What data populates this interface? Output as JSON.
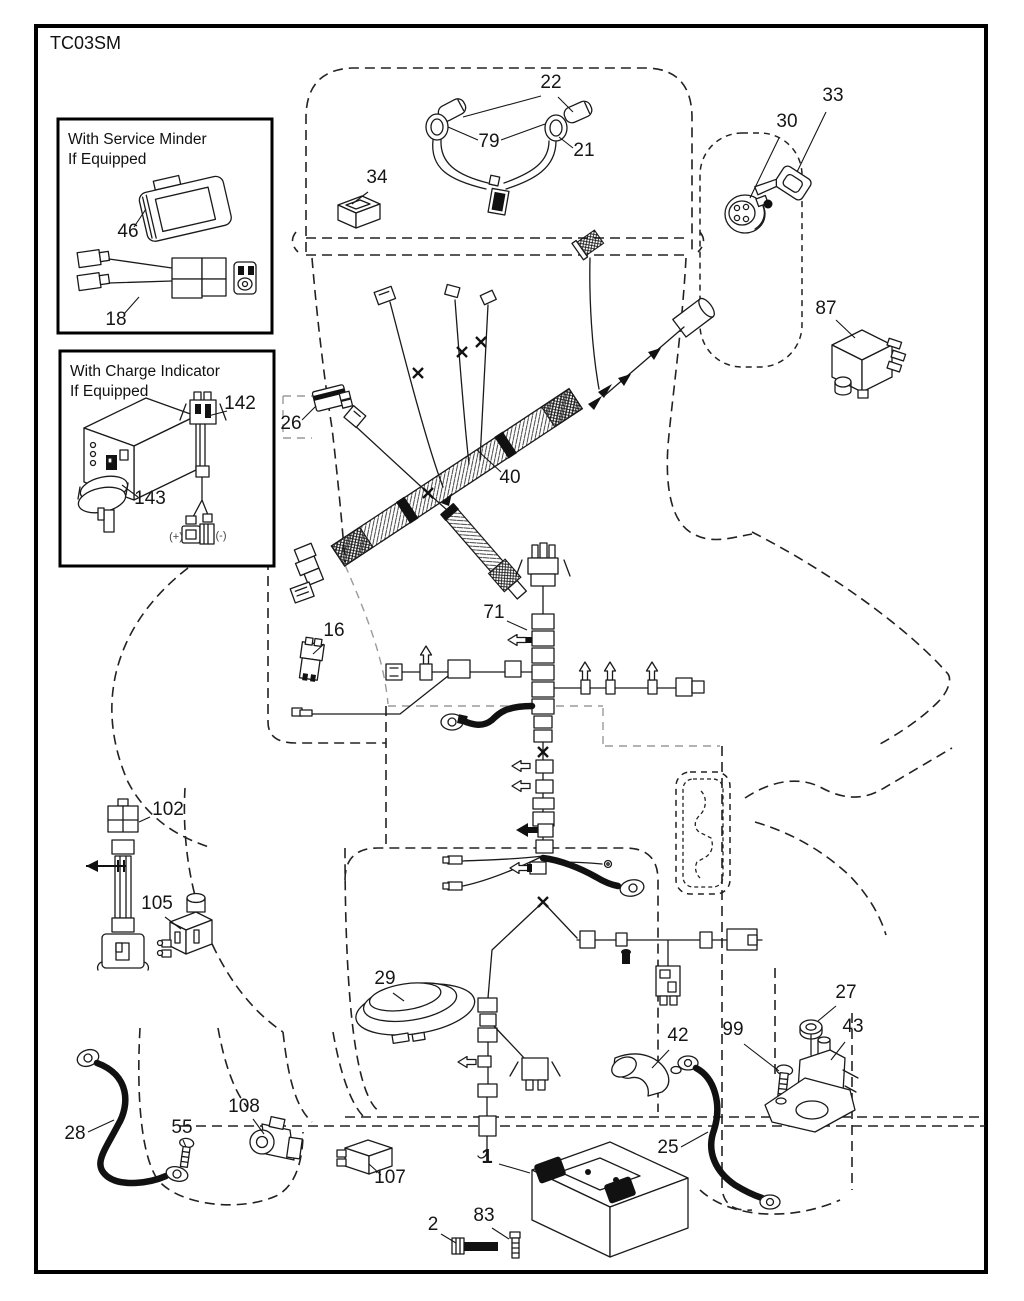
{
  "page": {
    "code": "TC03SM",
    "ink_color": "#1a1a1a",
    "background": "#ffffff"
  },
  "insets": {
    "service_minder": {
      "line1": "With Service Minder",
      "line2": "If Equipped"
    },
    "charge_indicator": {
      "line1": "With Charge Indicator",
      "line2": "If Equipped"
    }
  },
  "callouts": [
    {
      "id": "22",
      "label": "22",
      "x": 551,
      "y": 88,
      "leaders": [
        [
          541,
          96,
          463,
          117
        ],
        [
          558,
          97,
          573,
          112
        ]
      ]
    },
    {
      "id": "79",
      "label": "79",
      "x": 489,
      "y": 147,
      "leaders": [
        [
          478,
          140,
          448,
          127
        ],
        [
          501,
          140,
          545,
          124
        ]
      ]
    },
    {
      "id": "21",
      "label": "21",
      "x": 584,
      "y": 156,
      "leaders": [
        [
          573,
          148,
          559,
          137
        ]
      ]
    },
    {
      "id": "34",
      "label": "34",
      "x": 377,
      "y": 183,
      "leaders": [
        [
          368,
          192,
          352,
          204
        ]
      ]
    },
    {
      "id": "30",
      "label": "30",
      "x": 787,
      "y": 127,
      "leaders": [
        [
          779,
          138,
          750,
          198
        ]
      ]
    },
    {
      "id": "33",
      "label": "33",
      "x": 833,
      "y": 101,
      "leaders": [
        [
          826,
          112,
          797,
          172
        ]
      ]
    },
    {
      "id": "87",
      "label": "87",
      "x": 826,
      "y": 314,
      "leaders": [
        [
          836,
          320,
          855,
          338
        ]
      ]
    },
    {
      "id": "26",
      "label": "26",
      "x": 291,
      "y": 429,
      "leaders": [
        [
          302,
          420,
          316,
          406
        ]
      ]
    },
    {
      "id": "40",
      "label": "40",
      "x": 510,
      "y": 483,
      "leaders": [
        [
          501,
          472,
          477,
          450
        ]
      ]
    },
    {
      "id": "71",
      "label": "71",
      "x": 494,
      "y": 618,
      "leaders": [
        [
          507,
          621,
          527,
          630
        ]
      ]
    },
    {
      "id": "16",
      "label": "16",
      "x": 334,
      "y": 636,
      "leaders": [
        [
          324,
          644,
          313,
          654
        ]
      ]
    },
    {
      "id": "102",
      "label": "102",
      "x": 168,
      "y": 815,
      "leaders": [
        [
          150,
          817,
          139,
          822
        ]
      ]
    },
    {
      "id": "105",
      "label": "105",
      "x": 157,
      "y": 909,
      "leaders": [
        [
          165,
          917,
          181,
          929
        ]
      ]
    },
    {
      "id": "29",
      "label": "29",
      "x": 385,
      "y": 984,
      "leaders": [
        [
          393,
          993,
          404,
          1001
        ]
      ]
    },
    {
      "id": "42",
      "label": "42",
      "x": 678,
      "y": 1041,
      "leaders": [
        [
          669,
          1050,
          652,
          1068
        ]
      ]
    },
    {
      "id": "99",
      "label": "99",
      "x": 733,
      "y": 1035,
      "leaders": [
        [
          744,
          1044,
          779,
          1071
        ]
      ]
    },
    {
      "id": "27",
      "label": "27",
      "x": 846,
      "y": 998,
      "leaders": [
        [
          836,
          1006,
          818,
          1021
        ]
      ]
    },
    {
      "id": "43",
      "label": "43",
      "x": 853,
      "y": 1032,
      "leaders": [
        [
          845,
          1042,
          831,
          1060
        ]
      ]
    },
    {
      "id": "25",
      "label": "25",
      "x": 668,
      "y": 1153,
      "leaders": [
        [
          681,
          1147,
          708,
          1132
        ]
      ]
    },
    {
      "id": "28",
      "label": "28",
      "x": 75,
      "y": 1139,
      "leaders": [
        [
          88,
          1132,
          114,
          1120
        ]
      ]
    },
    {
      "id": "55",
      "label": "55",
      "x": 182,
      "y": 1133,
      "leaders": [
        [
          183,
          1140,
          186,
          1147
        ]
      ]
    },
    {
      "id": "108",
      "label": "108",
      "x": 244,
      "y": 1112,
      "leaders": [
        [
          253,
          1119,
          264,
          1134
        ]
      ]
    },
    {
      "id": "107",
      "label": "107",
      "x": 390,
      "y": 1183,
      "leaders": [
        [
          381,
          1175,
          369,
          1164
        ]
      ]
    },
    {
      "id": "1",
      "label": "1",
      "x": 487,
      "y": 1163,
      "bold": true,
      "leaders": [
        [
          499,
          1164,
          530,
          1173
        ]
      ]
    },
    {
      "id": "2",
      "label": "2",
      "x": 433,
      "y": 1230,
      "leaders": [
        [
          441,
          1234,
          456,
          1243
        ]
      ]
    },
    {
      "id": "83",
      "label": "83",
      "x": 484,
      "y": 1221,
      "leaders": [
        [
          492,
          1228,
          509,
          1239
        ]
      ]
    },
    {
      "id": "46",
      "label": "46",
      "x": 128,
      "y": 237,
      "leaders": [
        [
          134,
          227,
          146,
          209
        ]
      ]
    },
    {
      "id": "18",
      "label": "18",
      "x": 116,
      "y": 325,
      "leaders": [
        [
          124,
          314,
          139,
          297
        ]
      ]
    },
    {
      "id": "142",
      "label": "142",
      "x": 240,
      "y": 409,
      "leaders": [
        [
          227,
          411,
          208,
          416
        ]
      ]
    },
    {
      "id": "143",
      "label": "143",
      "x": 150,
      "y": 504,
      "leaders": [
        [
          138,
          497,
          122,
          485
        ]
      ]
    },
    {
      "id": "plus",
      "label": "(+)",
      "x": 176,
      "y": 540,
      "small": true,
      "leaders": []
    },
    {
      "id": "minus",
      "label": "(-)",
      "x": 221,
      "y": 539,
      "small": true,
      "leaders": []
    }
  ]
}
